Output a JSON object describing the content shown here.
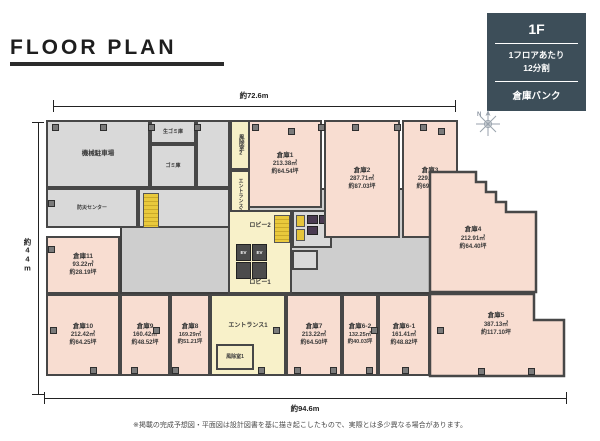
{
  "title": "FLOOR PLAN",
  "legend": {
    "floor": "1F",
    "division_line1": "1フロアあたり",
    "division_line2": "12分割",
    "brand": "倉庫バンク"
  },
  "dimensions": {
    "top": "約72.6m",
    "bottom": "約94.6m",
    "left": "約44m"
  },
  "compass": "N",
  "rooms": {
    "s1": {
      "name": "倉庫1",
      "m2": "213.38㎡",
      "tsubo": "約64.54坪"
    },
    "s2": {
      "name": "倉庫2",
      "m2": "287.71㎡",
      "tsubo": "約87.03坪"
    },
    "s3": {
      "name": "倉庫3",
      "m2": "229.99㎡",
      "tsubo": "約69.57坪"
    },
    "s4": {
      "name": "倉庫4",
      "m2": "212.91㎡",
      "tsubo": "約64.40坪"
    },
    "s5": {
      "name": "倉庫5",
      "m2": "387.13㎡",
      "tsubo": "約117.10坪"
    },
    "s6_1": {
      "name": "倉庫6-1",
      "m2": "161.41㎡",
      "tsubo": "約48.82坪"
    },
    "s6_2": {
      "name": "倉庫6-2",
      "m2": "132.25㎡",
      "tsubo": "約40.03坪"
    },
    "s7": {
      "name": "倉庫7",
      "m2": "213.22㎡",
      "tsubo": "約64.50坪"
    },
    "s8": {
      "name": "倉庫8",
      "m2": "169.29㎡",
      "tsubo": "約51.21坪"
    },
    "s9": {
      "name": "倉庫9",
      "m2": "160.42㎡",
      "tsubo": "約48.52坪"
    },
    "s10": {
      "name": "倉庫10",
      "m2": "212.42㎡",
      "tsubo": "約64.25坪"
    },
    "s11": {
      "name": "倉庫11",
      "m2": "93.22㎡",
      "tsubo": "約28.19坪"
    }
  },
  "facilities": {
    "parking": "機械駐車場",
    "garbage_raw": "生ゴミ庫",
    "garbage": "ゴミ庫",
    "disaster_center": "防災センター",
    "entrance1": "エントランス1",
    "entrance2": "エントランス2",
    "lobby1": "ロビー1",
    "lobby2": "ロビー2",
    "windbreak1": "風除室1",
    "windbreak2": "風除室2",
    "ev": "EV"
  },
  "disclaimer": "※掲載の完成予想図・平面図は設計図書を基に描き起こしたもので、実際とは多少異なる場合があります。"
}
